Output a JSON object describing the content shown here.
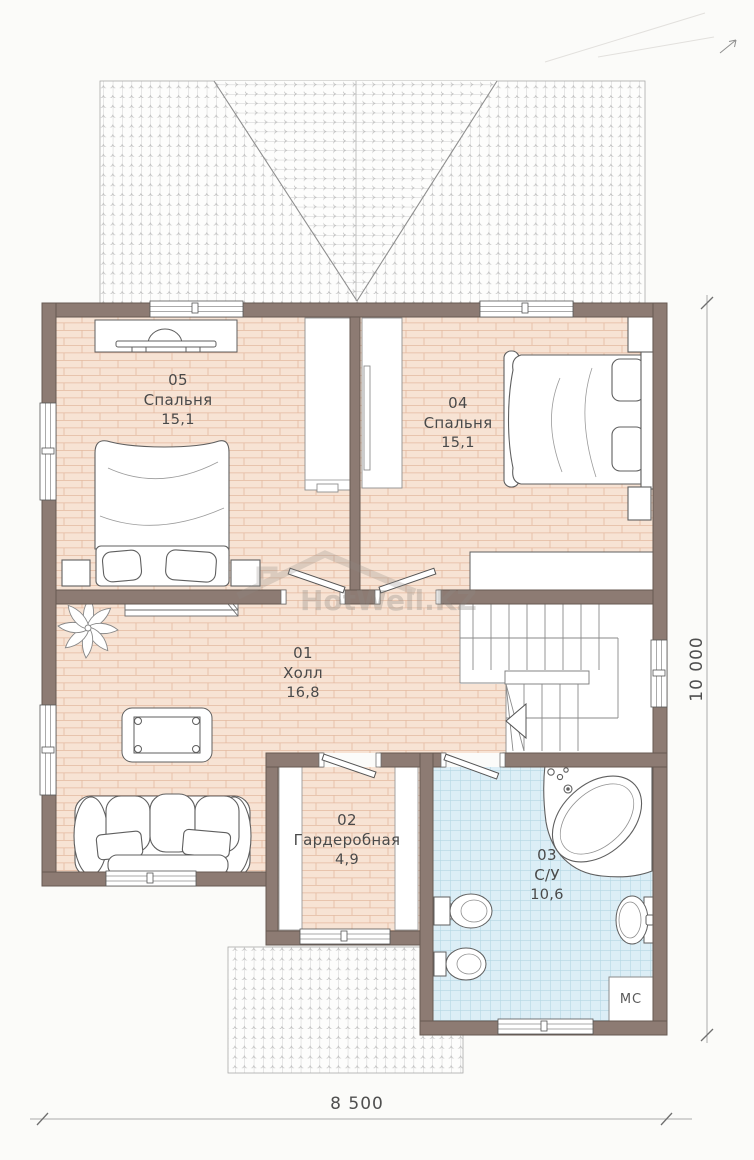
{
  "plan": {
    "watermark": "HotWell.KZ",
    "rooms": [
      {
        "number": "05",
        "name": "Спальня",
        "area": "15,1"
      },
      {
        "number": "04",
        "name": "Спальня",
        "area": "15,1"
      },
      {
        "number": "01",
        "name": "Холл",
        "area": "16,8"
      },
      {
        "number": "02",
        "name": "Гардеробная",
        "area": "4,9"
      },
      {
        "number": "03",
        "name": "С/У",
        "area": "10,6"
      }
    ],
    "appliances": {
      "washing_machine": "МС"
    },
    "dimensions": {
      "overall_width": "8 500",
      "overall_height": "10 000"
    },
    "colors": {
      "wall": "#8d7b73",
      "brick_floor": "#f7e3d4",
      "tile_floor": "#dceef6",
      "roof_line": "#bdbdbd",
      "text": "#4a4a4a"
    }
  }
}
